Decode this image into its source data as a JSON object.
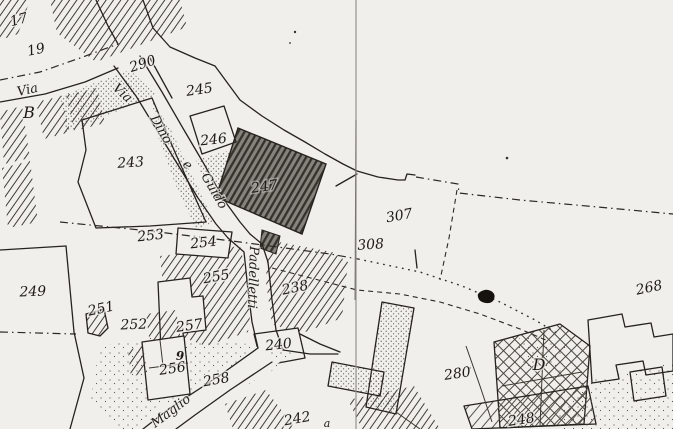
{
  "map": {
    "description": "Scanned black-and-white cadastral map extract",
    "highlighted_parcel": "247",
    "colors": {
      "paper": "#f0efeb",
      "ink": "#26231e",
      "highlight_fill": "#86837e",
      "fold_line": "#969390",
      "ink_blob": "#16130f"
    },
    "streets": {
      "via_west": "Via",
      "via_dino_prefix": "Via",
      "dino": "Dino",
      "e": "e",
      "guido": "Guido",
      "padelletti": "Padelletti",
      "maglio": "Maglio"
    },
    "parcels": {
      "p17": "17",
      "p19": "19",
      "p290": "290",
      "p245": "245",
      "p246": "246",
      "p243": "243",
      "p247": "247",
      "p253": "253",
      "p254": "254",
      "p255": "255",
      "p238": "238",
      "p257": "257",
      "p240": "240",
      "p249": "249",
      "p251": "251",
      "p252": "252",
      "p256": "256",
      "p258": "258",
      "p242": "242",
      "p307": "307",
      "p308": "308",
      "p268": "268",
      "p280": "280",
      "p248": "248"
    },
    "letters": {
      "b": "B",
      "d": "D",
      "nine": "9",
      "a": "a"
    }
  }
}
